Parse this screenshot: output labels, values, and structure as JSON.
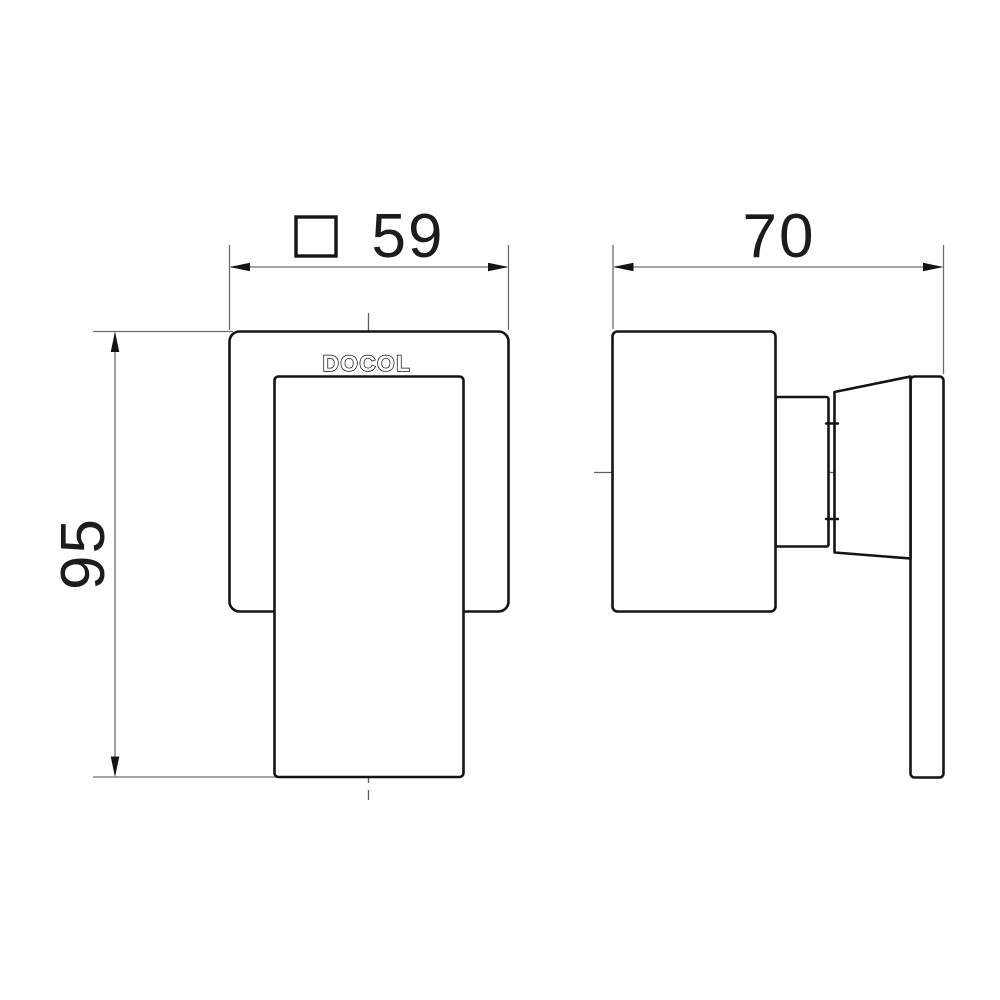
{
  "brand_logo": "DOCOL",
  "dimensions": {
    "front_width": "59",
    "front_height": "95",
    "side_depth": "70"
  },
  "symbols": {
    "front_width_prefix": "square-section-symbol"
  },
  "colors": {
    "object_line": "#141414",
    "dimension_line": "#6e6e6e",
    "background": "#ffffff"
  }
}
